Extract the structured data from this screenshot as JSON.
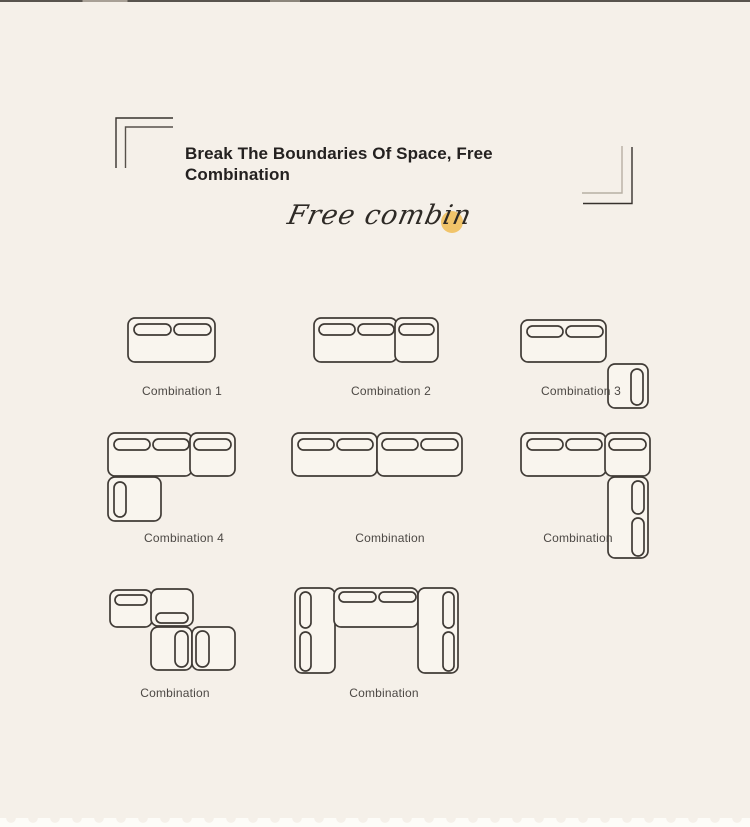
{
  "page": {
    "bg_color": "#f5f0e9",
    "top_edge_color": "#3d3833",
    "bottom_strip_color": "#fdfcf8"
  },
  "header": {
    "title_lines": [
      "Break The Boundaries Of Space, Free",
      "Combination"
    ],
    "title_color": "#242120",
    "script_text": "Free combin",
    "accent_dot_color": "#f1c46a"
  },
  "brackets": [
    {
      "name": "top-left",
      "lines": [
        {
          "points": "116,168 116,118 173,118",
          "color": "#37322d"
        },
        {
          "points": "125.5,168 125.5,127 173,127",
          "color": "#57514a"
        }
      ]
    },
    {
      "name": "bottom-right",
      "lines": [
        {
          "points": "622,146 622,193 582,193",
          "color": "#b7afa4"
        },
        {
          "points": "632,147 632,203.5 583,203.5",
          "color": "#37322d"
        }
      ]
    }
  ],
  "diagram_style": {
    "stroke": "#403b36",
    "fill": "#f9f5ee",
    "stroke_width": 1.7,
    "label_color": "#4c4844"
  },
  "combinations": [
    {
      "label": "Combination 1",
      "label_cx": 182,
      "label_cy": 391,
      "modules": [
        {
          "x": 128,
          "y": 318,
          "w": 87,
          "h": 44,
          "pills": [
            [
              134,
              324,
              37,
              11
            ],
            [
              174,
              324,
              37,
              11
            ]
          ]
        }
      ]
    },
    {
      "label": "Combination 2",
      "label_cx": 391,
      "label_cy": 391,
      "modules": [
        {
          "x": 314,
          "y": 318,
          "w": 83,
          "h": 44,
          "pills": [
            [
              319,
              324,
              36,
              11
            ],
            [
              358,
              324,
              36,
              11
            ]
          ]
        },
        {
          "x": 395,
          "y": 318,
          "w": 43,
          "h": 44,
          "pills": [
            [
              399,
              324,
              35,
              11
            ]
          ]
        }
      ]
    },
    {
      "label": "Combination 3",
      "label_cx": 581,
      "label_cy": 391,
      "modules": [
        {
          "x": 521,
          "y": 320,
          "w": 85,
          "h": 42,
          "pills": [
            [
              527,
              326,
              36,
              11
            ],
            [
              566,
              326,
              37,
              11
            ]
          ]
        },
        {
          "x": 608,
          "y": 364,
          "w": 40,
          "h": 44,
          "pills": [
            [
              631,
              369,
              12,
              36
            ]
          ]
        }
      ]
    },
    {
      "label": "Combination 4",
      "label_cx": 184,
      "label_cy": 538,
      "modules": [
        {
          "x": 108,
          "y": 433,
          "w": 84,
          "h": 43,
          "pills": [
            [
              114,
              439,
              36,
              11
            ],
            [
              153,
              439,
              36,
              11
            ]
          ]
        },
        {
          "x": 190,
          "y": 433,
          "w": 45,
          "h": 43,
          "pills": [
            [
              194,
              439,
              37,
              11
            ]
          ]
        },
        {
          "x": 108,
          "y": 477,
          "w": 53,
          "h": 44,
          "pills": [
            [
              114,
              482,
              12,
              35
            ]
          ]
        }
      ]
    },
    {
      "label": "Combination",
      "label_cx": 390,
      "label_cy": 538,
      "modules": [
        {
          "x": 292,
          "y": 433,
          "w": 85,
          "h": 43,
          "pills": [
            [
              298,
              439,
              36,
              11
            ],
            [
              337,
              439,
              36,
              11
            ]
          ]
        },
        {
          "x": 377,
          "y": 433,
          "w": 85,
          "h": 43,
          "pills": [
            [
              382,
              439,
              36,
              11
            ],
            [
              421,
              439,
              37,
              11
            ]
          ]
        }
      ]
    },
    {
      "label": "Combination",
      "label_cx": 578,
      "label_cy": 538,
      "modules": [
        {
          "x": 521,
          "y": 433,
          "w": 85,
          "h": 43,
          "pills": [
            [
              527,
              439,
              36,
              11
            ],
            [
              566,
              439,
              36,
              11
            ]
          ]
        },
        {
          "x": 605,
          "y": 433,
          "w": 45,
          "h": 43,
          "pills": [
            [
              609,
              439,
              37,
              11
            ]
          ]
        },
        {
          "x": 608,
          "y": 477,
          "w": 40,
          "h": 81,
          "pills": [
            [
              632,
              481,
              12,
              33
            ],
            [
              632,
              518,
              12,
              38
            ]
          ]
        }
      ]
    },
    {
      "label": "Combination",
      "label_cx": 175,
      "label_cy": 693,
      "modules": [
        {
          "x": 110,
          "y": 590,
          "w": 42,
          "h": 37,
          "pills": [
            [
              115,
              595,
              32,
              10
            ]
          ]
        },
        {
          "x": 151,
          "y": 589,
          "w": 42,
          "h": 37,
          "pills": [
            [
              156,
              613,
              32,
              10
            ]
          ]
        },
        {
          "x": 151,
          "y": 627,
          "w": 41,
          "h": 43,
          "pills": [
            [
              175,
              631,
              13,
              36
            ]
          ]
        },
        {
          "x": 192,
          "y": 627,
          "w": 43,
          "h": 43,
          "pills": [
            [
              196,
              631,
              13,
              36
            ]
          ]
        }
      ]
    },
    {
      "label": "Combination",
      "label_cx": 384,
      "label_cy": 693,
      "modules": [
        {
          "x": 295,
          "y": 588,
          "w": 40,
          "h": 85,
          "pills": [
            [
              300,
              592,
              11,
              36
            ],
            [
              300,
              632,
              11,
              39
            ]
          ]
        },
        {
          "x": 334,
          "y": 588,
          "w": 84,
          "h": 39,
          "pills": [
            [
              339,
              592,
              37,
              10
            ],
            [
              379,
              592,
              37,
              10
            ]
          ]
        },
        {
          "x": 418,
          "y": 588,
          "w": 40,
          "h": 85,
          "pills": [
            [
              443,
              592,
              11,
              36
            ],
            [
              443,
              632,
              11,
              39
            ]
          ]
        }
      ]
    }
  ]
}
